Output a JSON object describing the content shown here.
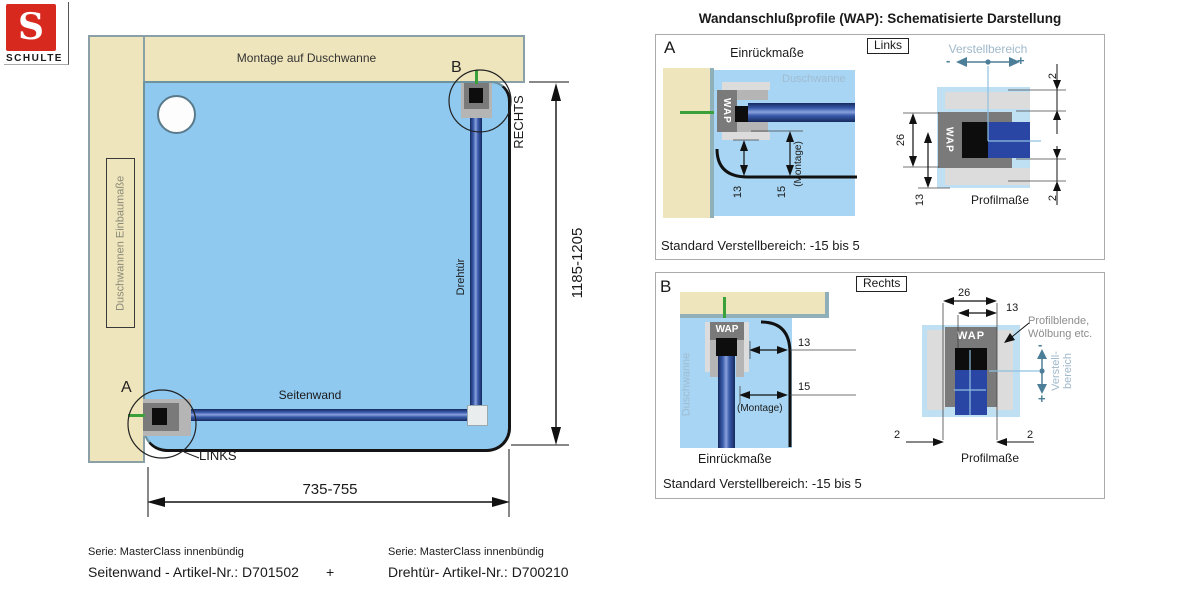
{
  "logo": {
    "letter": "S",
    "brand": "SCHULTE"
  },
  "left_diagram": {
    "top_wall_label": "Montage auf Duschwanne",
    "left_wall_label": "Duschwannen Einbaumaße",
    "marker_a": "A",
    "marker_b": "B",
    "links": "LINKS",
    "rechts": "RECHTS",
    "door": "Drehtür",
    "sidewall": "Seitenwand",
    "height_range": "1185-1205",
    "width_range": "735-755"
  },
  "panels_title": "Wandanschlußprofile (WAP): Schematisierte Darstellung",
  "panel_a": {
    "marker": "A",
    "einrueckmasse": "Einrückmaße",
    "tag": "Links",
    "verstellbereich": "Verstellbereich",
    "minus": "-",
    "plus": "+",
    "duschwanne": "Duschwanne",
    "wap": "WAP",
    "dim13": "13",
    "dim15": "15",
    "montage": "(Montage)",
    "dim26": "26",
    "dim13_profile": "13",
    "dim2_top": "2",
    "dim2_bottom": "2",
    "profilmasse": "Profilmaße",
    "standard": "Standard Verstellbereich: -15 bis 5"
  },
  "panel_b": {
    "marker": "B",
    "tag": "Rechts",
    "duschwanne": "Duschwanne",
    "wap_left": "WAP",
    "wap_right": "WAP",
    "dim13": "13",
    "dim15": "15",
    "montage": "(Montage)",
    "einrueckmasse": "Einrückmaße",
    "dim26": "26",
    "dim13_profile": "13",
    "dim2_left": "2",
    "dim2_right": "2",
    "profilblende_line1": "Profilblende,",
    "profilblende_line2": "Wölbung etc.",
    "verstell_line1": "Verstell-",
    "verstell_line2": "bereich",
    "minus": "-",
    "plus": "+",
    "profilmasse": "Profilmaße",
    "standard": "Standard Verstellbereich: -15 bis 5"
  },
  "footer": {
    "left_series": "Serie: MasterClass innenbündig",
    "left_article": "Seitenwand - Artikel-Nr.: D701502",
    "plus": "+",
    "right_series": "Serie: MasterClass innenbündig",
    "right_article": "Drehtür- Artikel-Nr.: D700210"
  },
  "colors": {
    "wall_beige": "#EFE5BC",
    "wall_edge_teal": "#8FB0B8",
    "tray_blue": "#8FC9F0",
    "panel_tray_blue": "#A8D5F3",
    "panel_bg_blue": "#BFDFF3",
    "glass_blue": "#2B4C9E",
    "profile_gray": "#7A7A7A",
    "steel_blue_text": "#9FB9CB",
    "steel_blue_arrow": "#4D7E98",
    "green_mark": "#3AA13A",
    "logo_red": "#D8291E"
  }
}
